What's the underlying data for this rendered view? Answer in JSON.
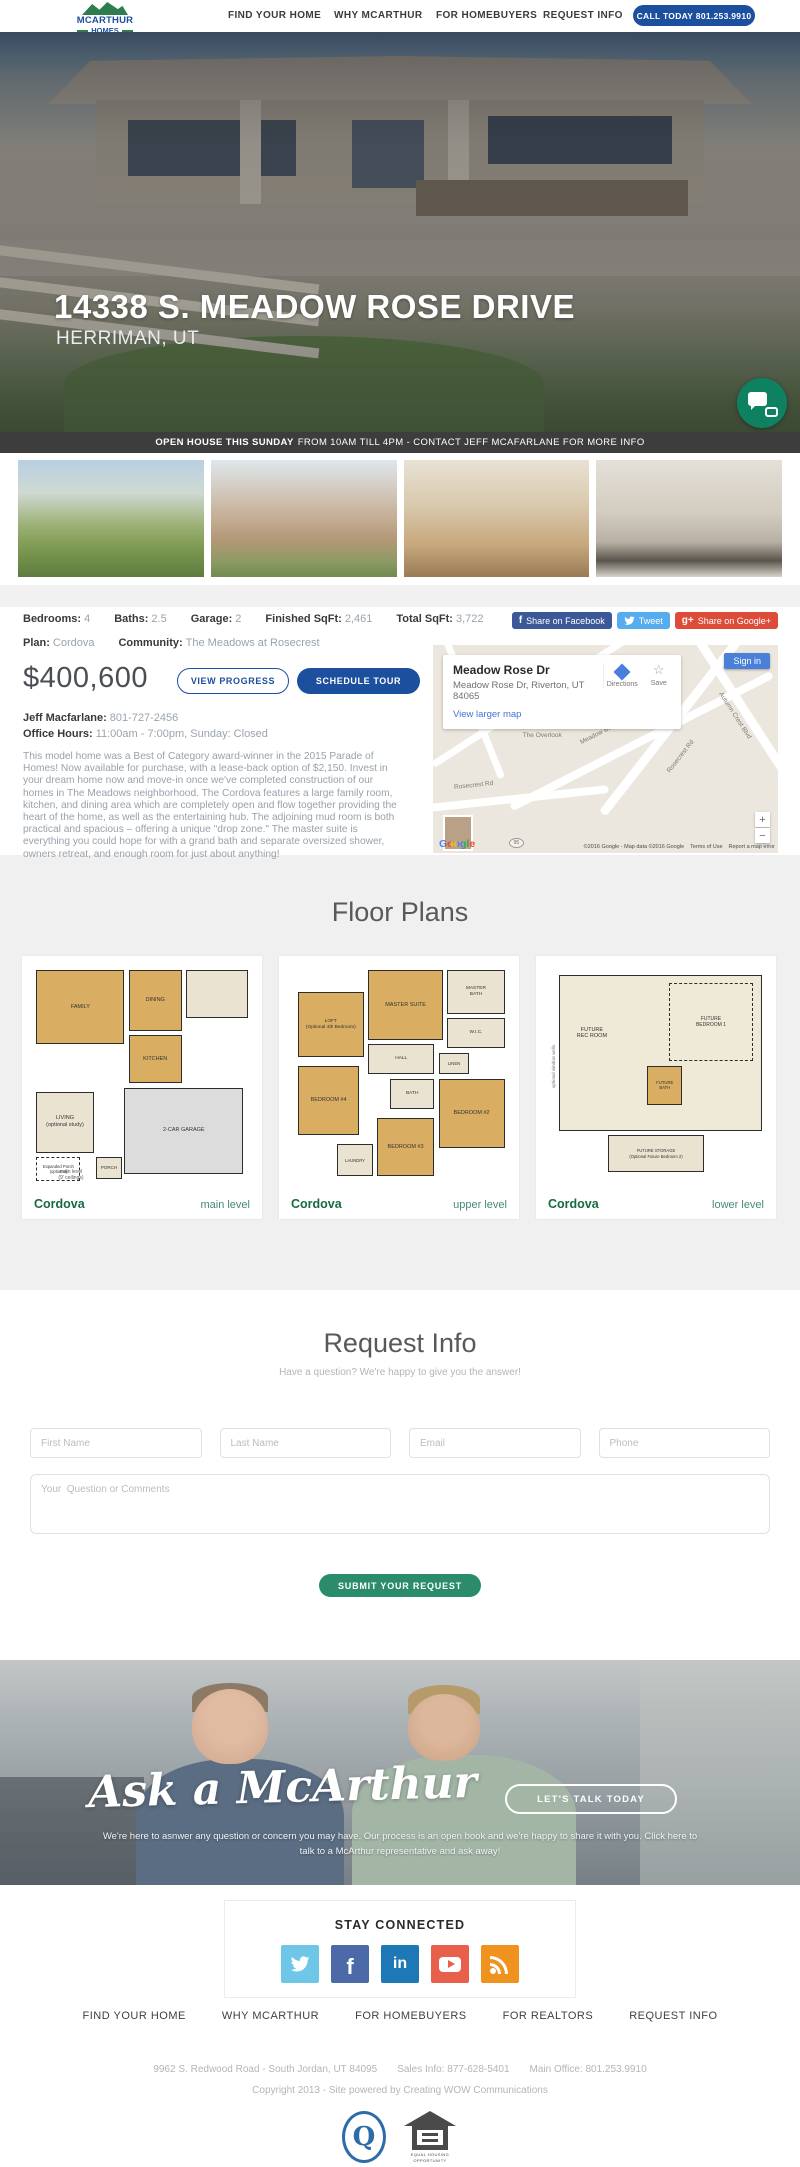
{
  "brand": {
    "name_top": "MCARTHUR",
    "name_bottom": "HOMES"
  },
  "header": {
    "nav": [
      "FIND YOUR HOME",
      "WHY MCARTHUR",
      "FOR HOMEBUYERS",
      "REQUEST INFO"
    ],
    "call_button": "CALL TODAY  801.253.9910"
  },
  "hero": {
    "title": "14338 S. MEADOW ROSE DRIVE",
    "subtitle": "HERRIMAN, UT"
  },
  "banner": {
    "highlight": "OPEN HOUSE THIS SUNDAY",
    "rest": "FROM 10AM TILL 4PM - CONTACT JEFF MCAFARLANE FOR MORE INFO"
  },
  "gallery": {
    "thumbnails": [
      {
        "name": "community-aerial-view"
      },
      {
        "name": "home-exterior"
      },
      {
        "name": "living-room-interior"
      },
      {
        "name": "kitchen-interior"
      }
    ]
  },
  "property": {
    "meta": [
      {
        "label": "Bedrooms:",
        "value": "4"
      },
      {
        "label": "Baths:",
        "value": "2.5"
      },
      {
        "label": "Garage:",
        "value": "2"
      },
      {
        "label": "Finished SqFt:",
        "value": "2,461"
      },
      {
        "label": "Total SqFt:",
        "value": "3,722"
      }
    ],
    "plan_label": "Plan:",
    "plan_value": "Cordova",
    "community_label": "Community:",
    "community_value": "The Meadows at Rosecrest",
    "price": "$400,600",
    "view_progress": "VIEW PROGRESS",
    "schedule_tour": "SCHEDULE TOUR",
    "agent_label": "Jeff Macfarlane:",
    "agent_phone": "801-727-2456",
    "office_label": "Office Hours:",
    "office_value": "11:00am - 7:00pm, Sunday: Closed",
    "description": "This model home was a Best of Category award-winner in the 2015 Parade of Homes! Now available for purchase, with a lease-back option of $2,150. Invest in your dream home now and move-in once we've completed construction of our homes in The Meadows neighborhood. The Cordova features a large family room, kitchen, and dining area which are completely open and flow together providing the heart of the home, as well as the entertaining hub. The adjoining mud room is both practical and spacious – offering a unique \"drop zone.\" The master suite is everything you could hope for with a grand bath and separate oversized shower, owners retreat, and enough room for just about anything!"
  },
  "share": {
    "facebook": "Share on Facebook",
    "facebook_glyph": "f",
    "twitter": "Tweet",
    "google": "Share on Google+",
    "google_glyph": "g+"
  },
  "map": {
    "title": "Meadow Rose Dr",
    "address": "Meadow Rose Dr, Riverton, UT 84065",
    "larger_link": "View larger map",
    "directions_label": "Directions",
    "save_label": "Save",
    "save_glyph": "☆",
    "sign_in": "Sign in",
    "streets": {
      "s1": "Breezy Meadow Dr",
      "s2": "Meadow Bend Dr",
      "s3": "Autumn Crest Blvd",
      "s4": "The Overlook",
      "s5": "Rosecrest Rd",
      "s6": "Rosecrest Rd"
    },
    "shield": "95",
    "logo": "Google",
    "attribution": "©2016 Google - Map data ©2016 Google",
    "terms": "Terms of Use",
    "report": "Report a map error",
    "zoom_in": "+",
    "zoom_out": "−"
  },
  "floor_plans": {
    "title": "Floor Plans",
    "plans": [
      {
        "name": "Cordova",
        "level": "main level",
        "rooms": {
          "family": "FAMILY",
          "dining": "DINING",
          "kitchen": "KITCHEN",
          "living": "LIVING\n(optional study)",
          "garage": "2-CAR GARAGE",
          "porch": "PORCH",
          "expanded": "Expanded Porch\n(optional)"
        },
        "note": "main level\n(9' ceilings)"
      },
      {
        "name": "Cordova",
        "level": "upper level",
        "rooms": {
          "loft": "LOFT\n(Optional 4th Bedroom)",
          "master": "MASTER SUITE",
          "mbath": "MASTER\nBATH",
          "wic": "W.I.C.",
          "hall": "HALL",
          "linen": "LINEN",
          "bath": "BATH",
          "bed4": "BEDROOM #4",
          "bed2": "BEDROOM #2",
          "bed3": "BEDROOM #3",
          "laundry": "LAUNDRY"
        }
      },
      {
        "name": "Cordova",
        "level": "lower level",
        "rooms": {
          "rec": "FUTURE\nREC ROOM",
          "bed1": "FUTURE\nBEDROOM 1",
          "bath": "FUTURE\nBATH",
          "storage": "FUTURE STORAGE\n(Optional Future Bedroom 2)",
          "wells": "optional window wells"
        }
      }
    ]
  },
  "request": {
    "title": "Request Info",
    "subtitle": "Have a question? We're happy to give you the answer!",
    "fields": [
      "First Name",
      "Last Name",
      "Email",
      "Phone"
    ],
    "comments_placeholder": "Your  Question or Comments",
    "submit": "SUBMIT YOUR REQUEST"
  },
  "ask": {
    "title": "Ask a McArthur",
    "button": "LET'S TALK TODAY",
    "text": "We're here to asnwer any question or concern you may have.  Our process is an open book and we're happy to share it with you. Click here to talk to a McArthur representative and ask away!"
  },
  "social": {
    "title": "STAY CONNECTED",
    "icons": [
      {
        "name": "twitter",
        "color": "#6ec6e8"
      },
      {
        "name": "facebook",
        "color": "#4d6aa8",
        "glyph": "f"
      },
      {
        "name": "linkedin",
        "color": "#1e78b5",
        "glyph": "in"
      },
      {
        "name": "youtube",
        "color": "#e8604c"
      },
      {
        "name": "rss",
        "color": "#f0921e"
      }
    ]
  },
  "footer": {
    "nav": [
      "FIND YOUR HOME",
      "WHY MCARTHUR",
      "FOR HOMEBUYERS",
      "FOR REALTORS",
      "REQUEST INFO"
    ],
    "address": "9962 S. Redwood Road - South Jordan, UT 84095",
    "sales": "Sales Info: 877-628-5401",
    "main_office": "Main Office: 801.253.9910",
    "copyright": "Copyright 2013  -  Site powered by Creating WOW Communications",
    "guild_q": "Q",
    "equal_housing": "EQUAL HOUSING\nOPPORTUNITY"
  }
}
